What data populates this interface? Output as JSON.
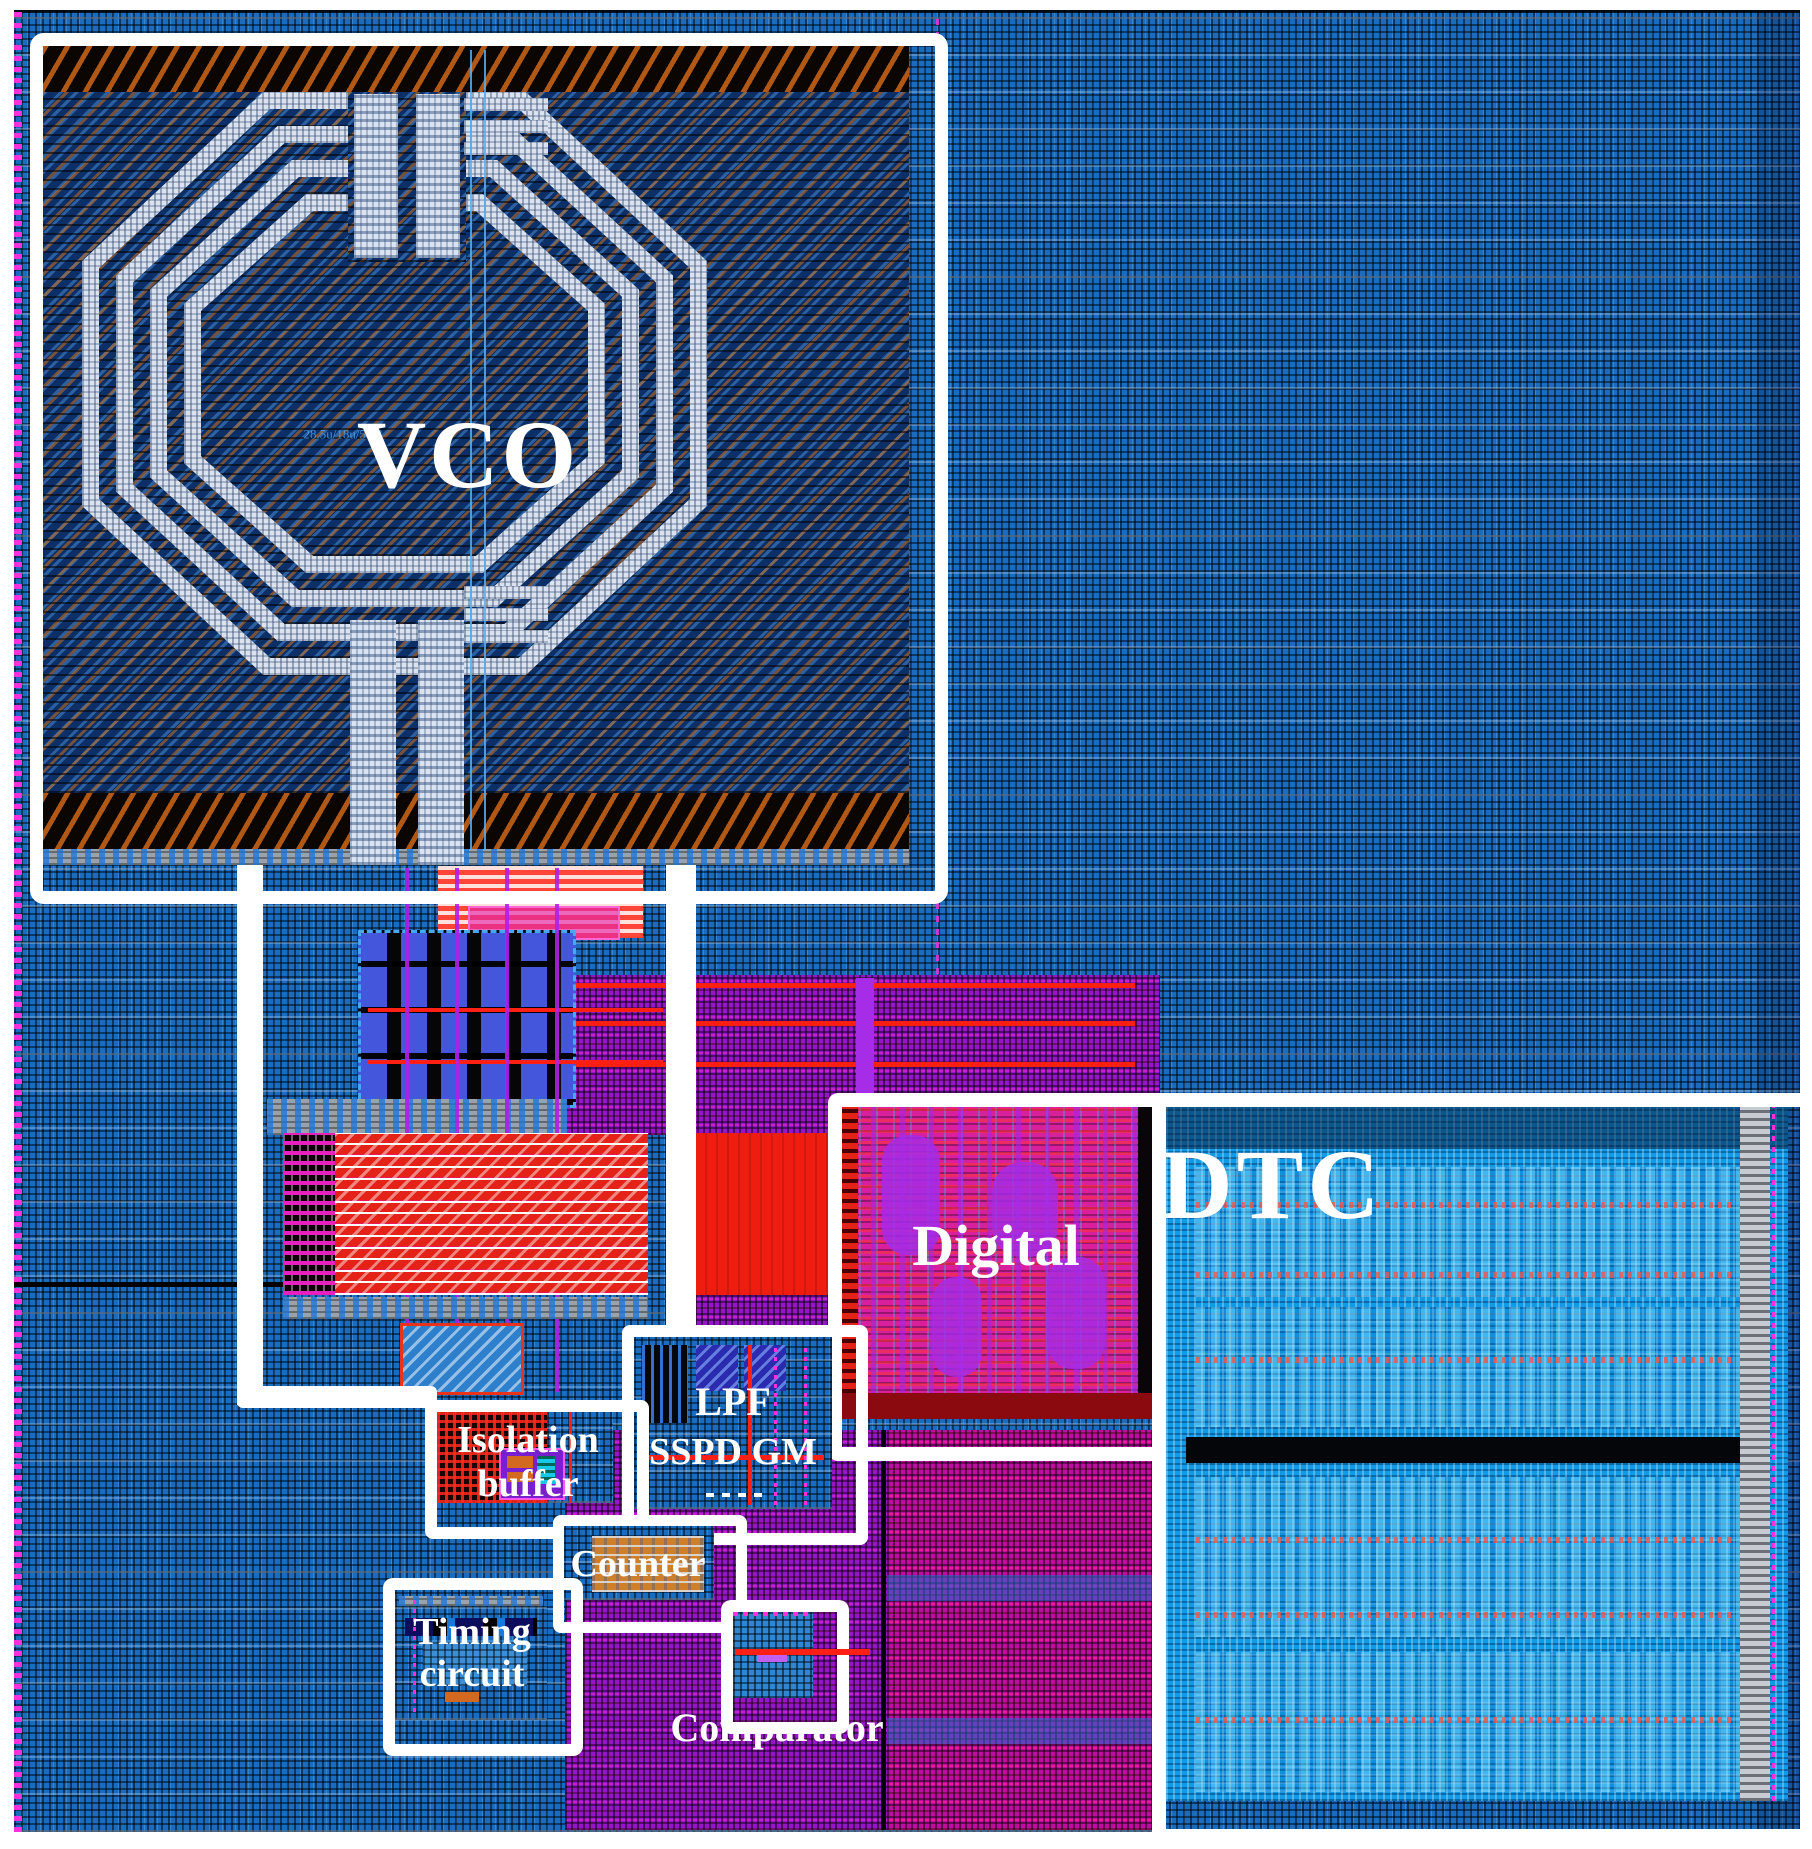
{
  "figure": {
    "kind": "annotated chip layout micrograph",
    "blocks": [
      "VCO",
      "Digital",
      "DTC",
      "LPF",
      "SSPD GM",
      "Isolation buffer",
      "Counter",
      "Timing circuit",
      "Comparator"
    ]
  },
  "labels": {
    "vco": "VCO",
    "digital": "Digital",
    "dtc": "DTC",
    "lpf": "LPF",
    "sspd_gm": "SSPD GM",
    "isolation_line1": "Isolation",
    "isolation_line2": "buffer",
    "counter": "Counter",
    "timing_line1": "Timing",
    "timing_line2": "circuit",
    "comparator": "Comparator",
    "coil_annotation": "28.5u/18u/5u/3"
  },
  "colors": {
    "background_metal_fill": "#1a6cc0",
    "vco_interior": "#0b2f66",
    "seal_ring_band": "#0c0602",
    "inductor_trace": "#d9e2ee",
    "cap_bank_red": "#e42218",
    "bright_red_block": "#ee1d10",
    "purple_fill": "#9715c8",
    "digital_pink": "#d81f9c",
    "dtc_blue": "#0f9be6",
    "counter_orange": "#cf7f2a",
    "annotation_box": "#ffffff",
    "label_text": "#ffffff"
  }
}
